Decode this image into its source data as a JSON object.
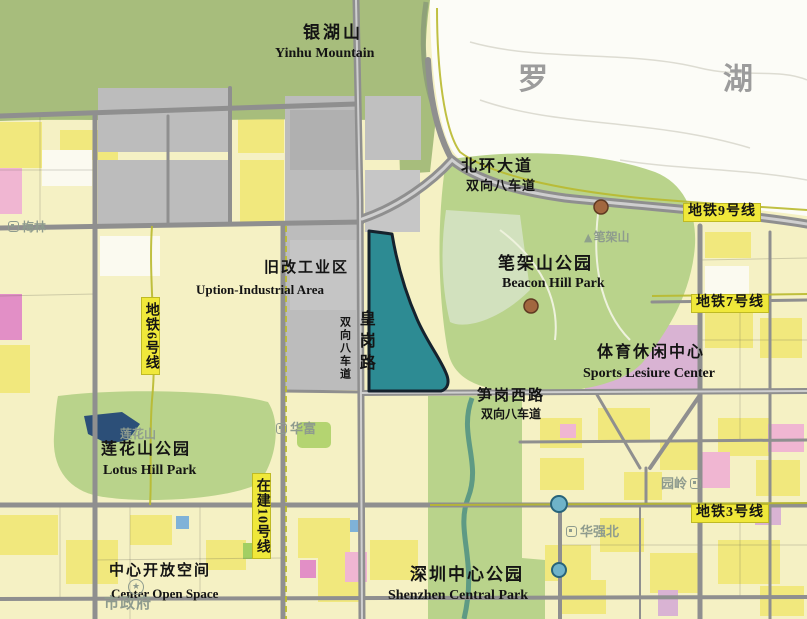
{
  "labels": {
    "yinhu_zh": "银湖山",
    "yinhu_en": "Yinhu Mountain",
    "district": "罗湖",
    "beihuan_zh": "北环大道",
    "beihuan_sub": "双向八车道",
    "metro9": "地铁9号线",
    "bijiashan": "笔架山",
    "beacon_zh": "笔架山公园",
    "beacon_en": "Beacon Hill Park",
    "uption_zh": "旧改工业区",
    "uption_en": "Uption-Industrial Area",
    "metro7": "地铁7号线",
    "metro6": "地铁6号线",
    "huanggang": "皇岗路",
    "huanggang_sub": "双向八车道",
    "sports_zh": "体育休闲中心",
    "sports_en": "Sports Lesiure Center",
    "sungang_zh": "笋岗西路",
    "sungang_sub": "双向八车道",
    "lianhuashan": "莲花山",
    "lotus_zh": "莲花山公园",
    "lotus_en": "Lotus Hill Park",
    "metro10": "在建10号线",
    "metro3": "地铁3号线",
    "cos_zh": "中心开放空间",
    "cos_en": "Center Open Space",
    "scp_zh": "深圳中心公园",
    "scp_en": "Shenzhen Central Park",
    "st_meilin": "梅林",
    "st_huafu": "华富",
    "st_huaqiangbei": "华强北",
    "st_yuanling": "园岭",
    "st_shizhengfu": "市政府"
  },
  "icons": {
    "peak": "▲",
    "star": "★"
  },
  "colors": {
    "parcel_teal": "#2d8b93",
    "metro_label_bg": "#f0e83a",
    "district_text": "#9c9c9c",
    "mountain_green": "#a7bd7c",
    "park_green": "#b9d38b",
    "urban_yellow": "#f5f1c4",
    "bright_yellow": "#f1e87d",
    "industrial_gray": "#bcbcbc",
    "road_gray": "#8f8f8f",
    "metro_line_olive": "#b9b92e",
    "lake_navy": "#2c4f78",
    "station_faint": "#8e9b8e"
  }
}
